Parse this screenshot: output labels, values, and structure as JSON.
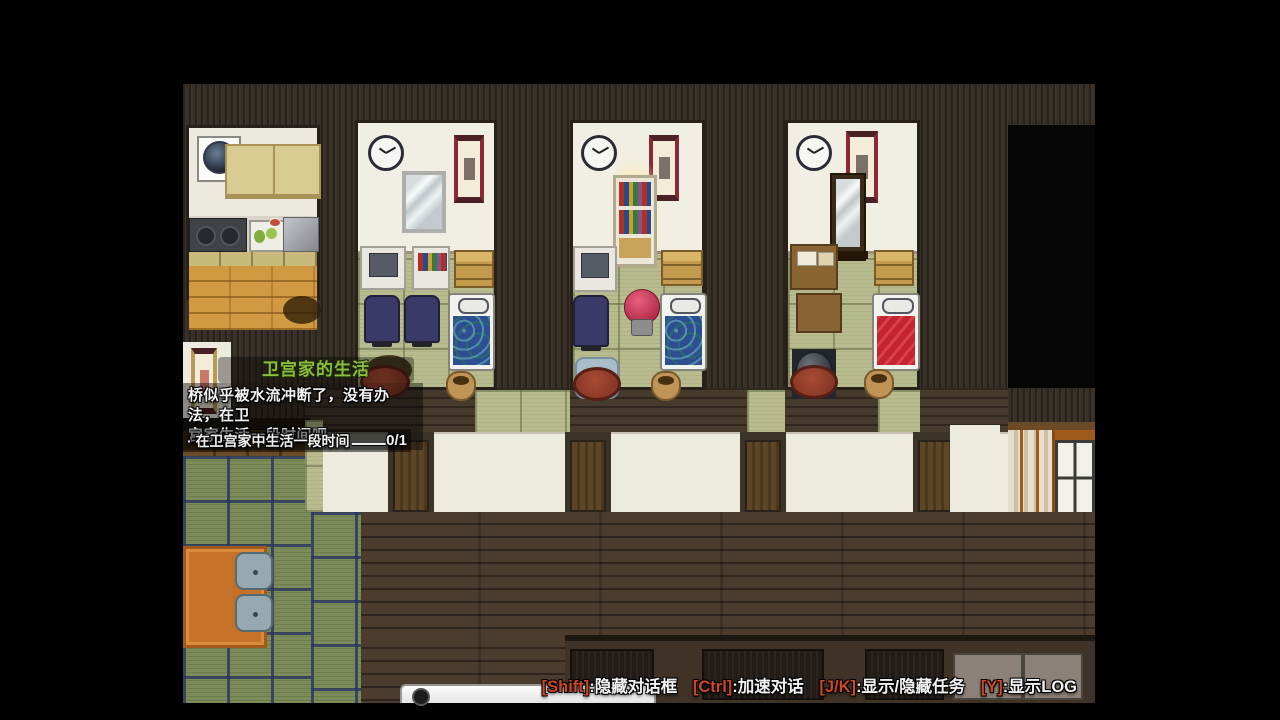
{
  "quest": {
    "title": "卫宫家的生活",
    "description": {
      "line1": "桥似乎被水流冲断了，没有办法，在卫",
      "line2": "宫家生活一段时间吧。"
    },
    "task": {
      "label": "· 在卫宫家中生活一段时间",
      "progress": "0/1"
    }
  },
  "hotkey_bar": {
    "items": [
      {
        "key": "[Shift]",
        "label": ":隐藏对话框"
      },
      {
        "key": "[Ctrl]",
        "label": ":加速对话"
      },
      {
        "key": "[J/K]",
        "label": ":显示/隐藏任务"
      },
      {
        "key": "[Y]",
        "label": ":显示LOG"
      }
    ]
  },
  "colors": {
    "quest_title": "#8abc3f",
    "hotkey_key": "#cf4727",
    "text": "#f2f2f2",
    "letterbox": "#000000"
  }
}
